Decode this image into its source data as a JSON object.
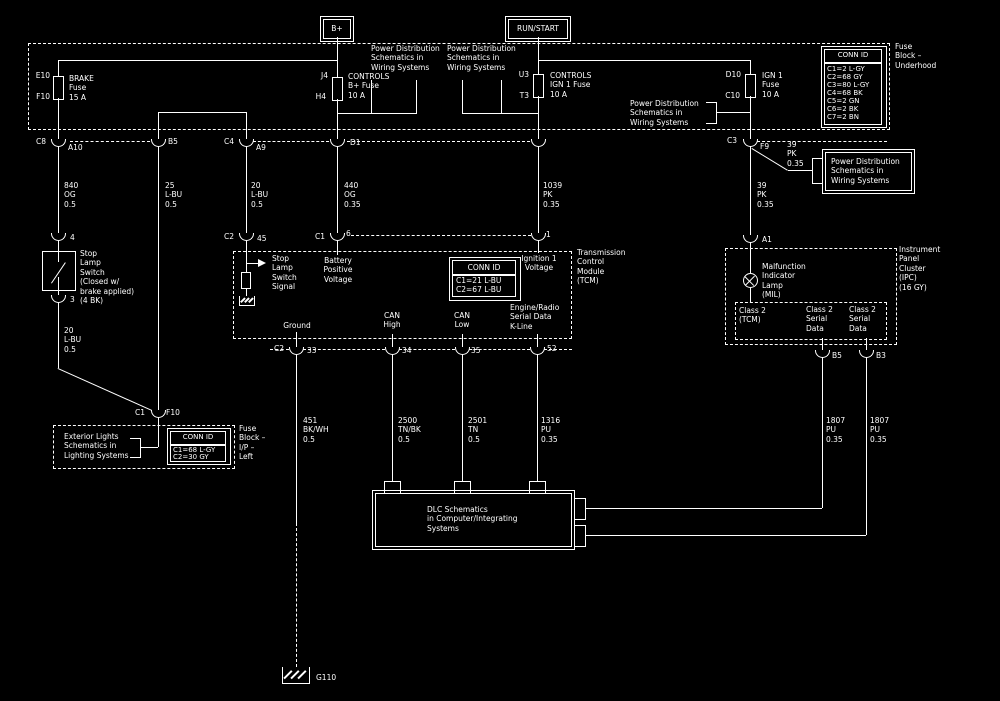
{
  "colors": {
    "background": "#000000",
    "line": "#ffffff"
  },
  "feeds": {
    "bplus": "B+",
    "runstart": "RUN/START"
  },
  "notes": {
    "pd1": "Power Distribution\nSchematics in\nWiring Systems",
    "pd2": "Power Distribution\nSchematics in\nWiring Systems",
    "pd3": "Power Distribution\nSchematics in\nWiring Systems",
    "pd_box": "Power Distribution\nSchematics in\nWiring Systems",
    "exterior": "Exterior Lights\nSchematics in\nLighting Systems",
    "dlc": "DLC Schematics\nin Computer/Integrating\nSystems"
  },
  "underhood": {
    "label": "Fuse\nBlock –\nUnderhood",
    "connid": {
      "header": "CONN ID",
      "rows": [
        "C1=2 L-GY",
        "C2=68 GY",
        "C3=80 L-GY",
        "C4=68 BK",
        "C5=2 GN",
        "C6=2 BK",
        "C7=2 BN"
      ]
    },
    "fuses": {
      "brake": {
        "pin_top": "E10",
        "pin_bottom": "F10",
        "name": "BRAKE\nFuse\n15 A"
      },
      "controls_b": {
        "pin_top": "J4",
        "pin_bottom": "H4",
        "name": "CONTROLS\nB+ Fuse\n10 A"
      },
      "controls_ign": {
        "pin_top": "U3",
        "pin_bottom": "T3",
        "name": "CONTROLS\nIGN 1 Fuse\n10 A"
      },
      "ign1": {
        "pin_top": "D10",
        "pin_bottom": "C10",
        "name": "IGN 1\nFuse\n10 A"
      }
    },
    "pins": {
      "c8": "C8",
      "a10": "A10",
      "b5": "B5",
      "c4": "C4",
      "a9": "A9",
      "d1": "D1",
      "c3": "C3",
      "f9": "F9"
    }
  },
  "wires": {
    "w840": "840\nOG\n0.5",
    "w25": "25\nL-BU\n0.5",
    "w20_tcm": "20\nL-BU\n0.5",
    "w20_switch": "20\nL-BU\n0.5",
    "w440": "440\nOG\n0.35",
    "w1039": "1039\nPK\n0.35",
    "w39_main": "39\nPK\n0.35",
    "w39_branch": "39\nPK\n0.35",
    "w451": "451\nBK/WH\n0.5",
    "w2500": "2500\nTN/BK\n0.5",
    "w2501": "2501\nTN\n0.5",
    "w1316": "1316\nPU\n0.35",
    "w1807_left": "1807\nPU\n0.35",
    "w1807_right": "1807\nPU\n0.35"
  },
  "stop_switch": {
    "pin_in": "4",
    "pin_out": "3",
    "label": "Stop\nLamp\nSwitch\n(Closed w/\nbrake applied)\n(4 BK)"
  },
  "ip_block": {
    "pin_conn": "C1",
    "pin": "F10",
    "connid": {
      "header": "CONN ID",
      "rows": [
        "C1=68 L-GY",
        "C2=30 GY"
      ]
    },
    "label": "Fuse\nBlock –\nI/P –\nLeft"
  },
  "tcm": {
    "label": "Transmission\nControl\nModule\n(TCM)",
    "connid": {
      "header": "CONN ID",
      "rows": [
        "C1=21 L-BU",
        "C2=67 L-BU"
      ]
    },
    "pins_top": {
      "c2": "C2",
      "p45": "45",
      "c1": "C1",
      "p6": "6",
      "p1": "1"
    },
    "pins_bottom": {
      "c2": "C2",
      "p33": "33",
      "p34": "34",
      "p35": "35",
      "p52": "52"
    },
    "signals": {
      "stop": "Stop\nLamp\nSwitch\nSignal",
      "battery": "Battery\nPositive\nVoltage",
      "ignition": "Ignition 1\nVoltage",
      "ground": "Ground",
      "can_high": "CAN\nHigh",
      "can_low": "CAN\nLow",
      "kline": "Engine/Radio\nSerial Data\nK-Line"
    }
  },
  "ipc": {
    "label": "Instrument\nPanel\nCluster\n(IPC)\n(16 GY)",
    "pin_a1": "A1",
    "mil": "Malfunction\nIndicator\nLamp\n(MIL)",
    "class2_tcm": "Class 2\n(TCM)",
    "class2_left": "Class 2\nSerial\nData",
    "class2_right": "Class 2\nSerial\nData",
    "pin_b5": "B5",
    "pin_b3": "B3"
  },
  "ground": {
    "g110": "G110"
  }
}
